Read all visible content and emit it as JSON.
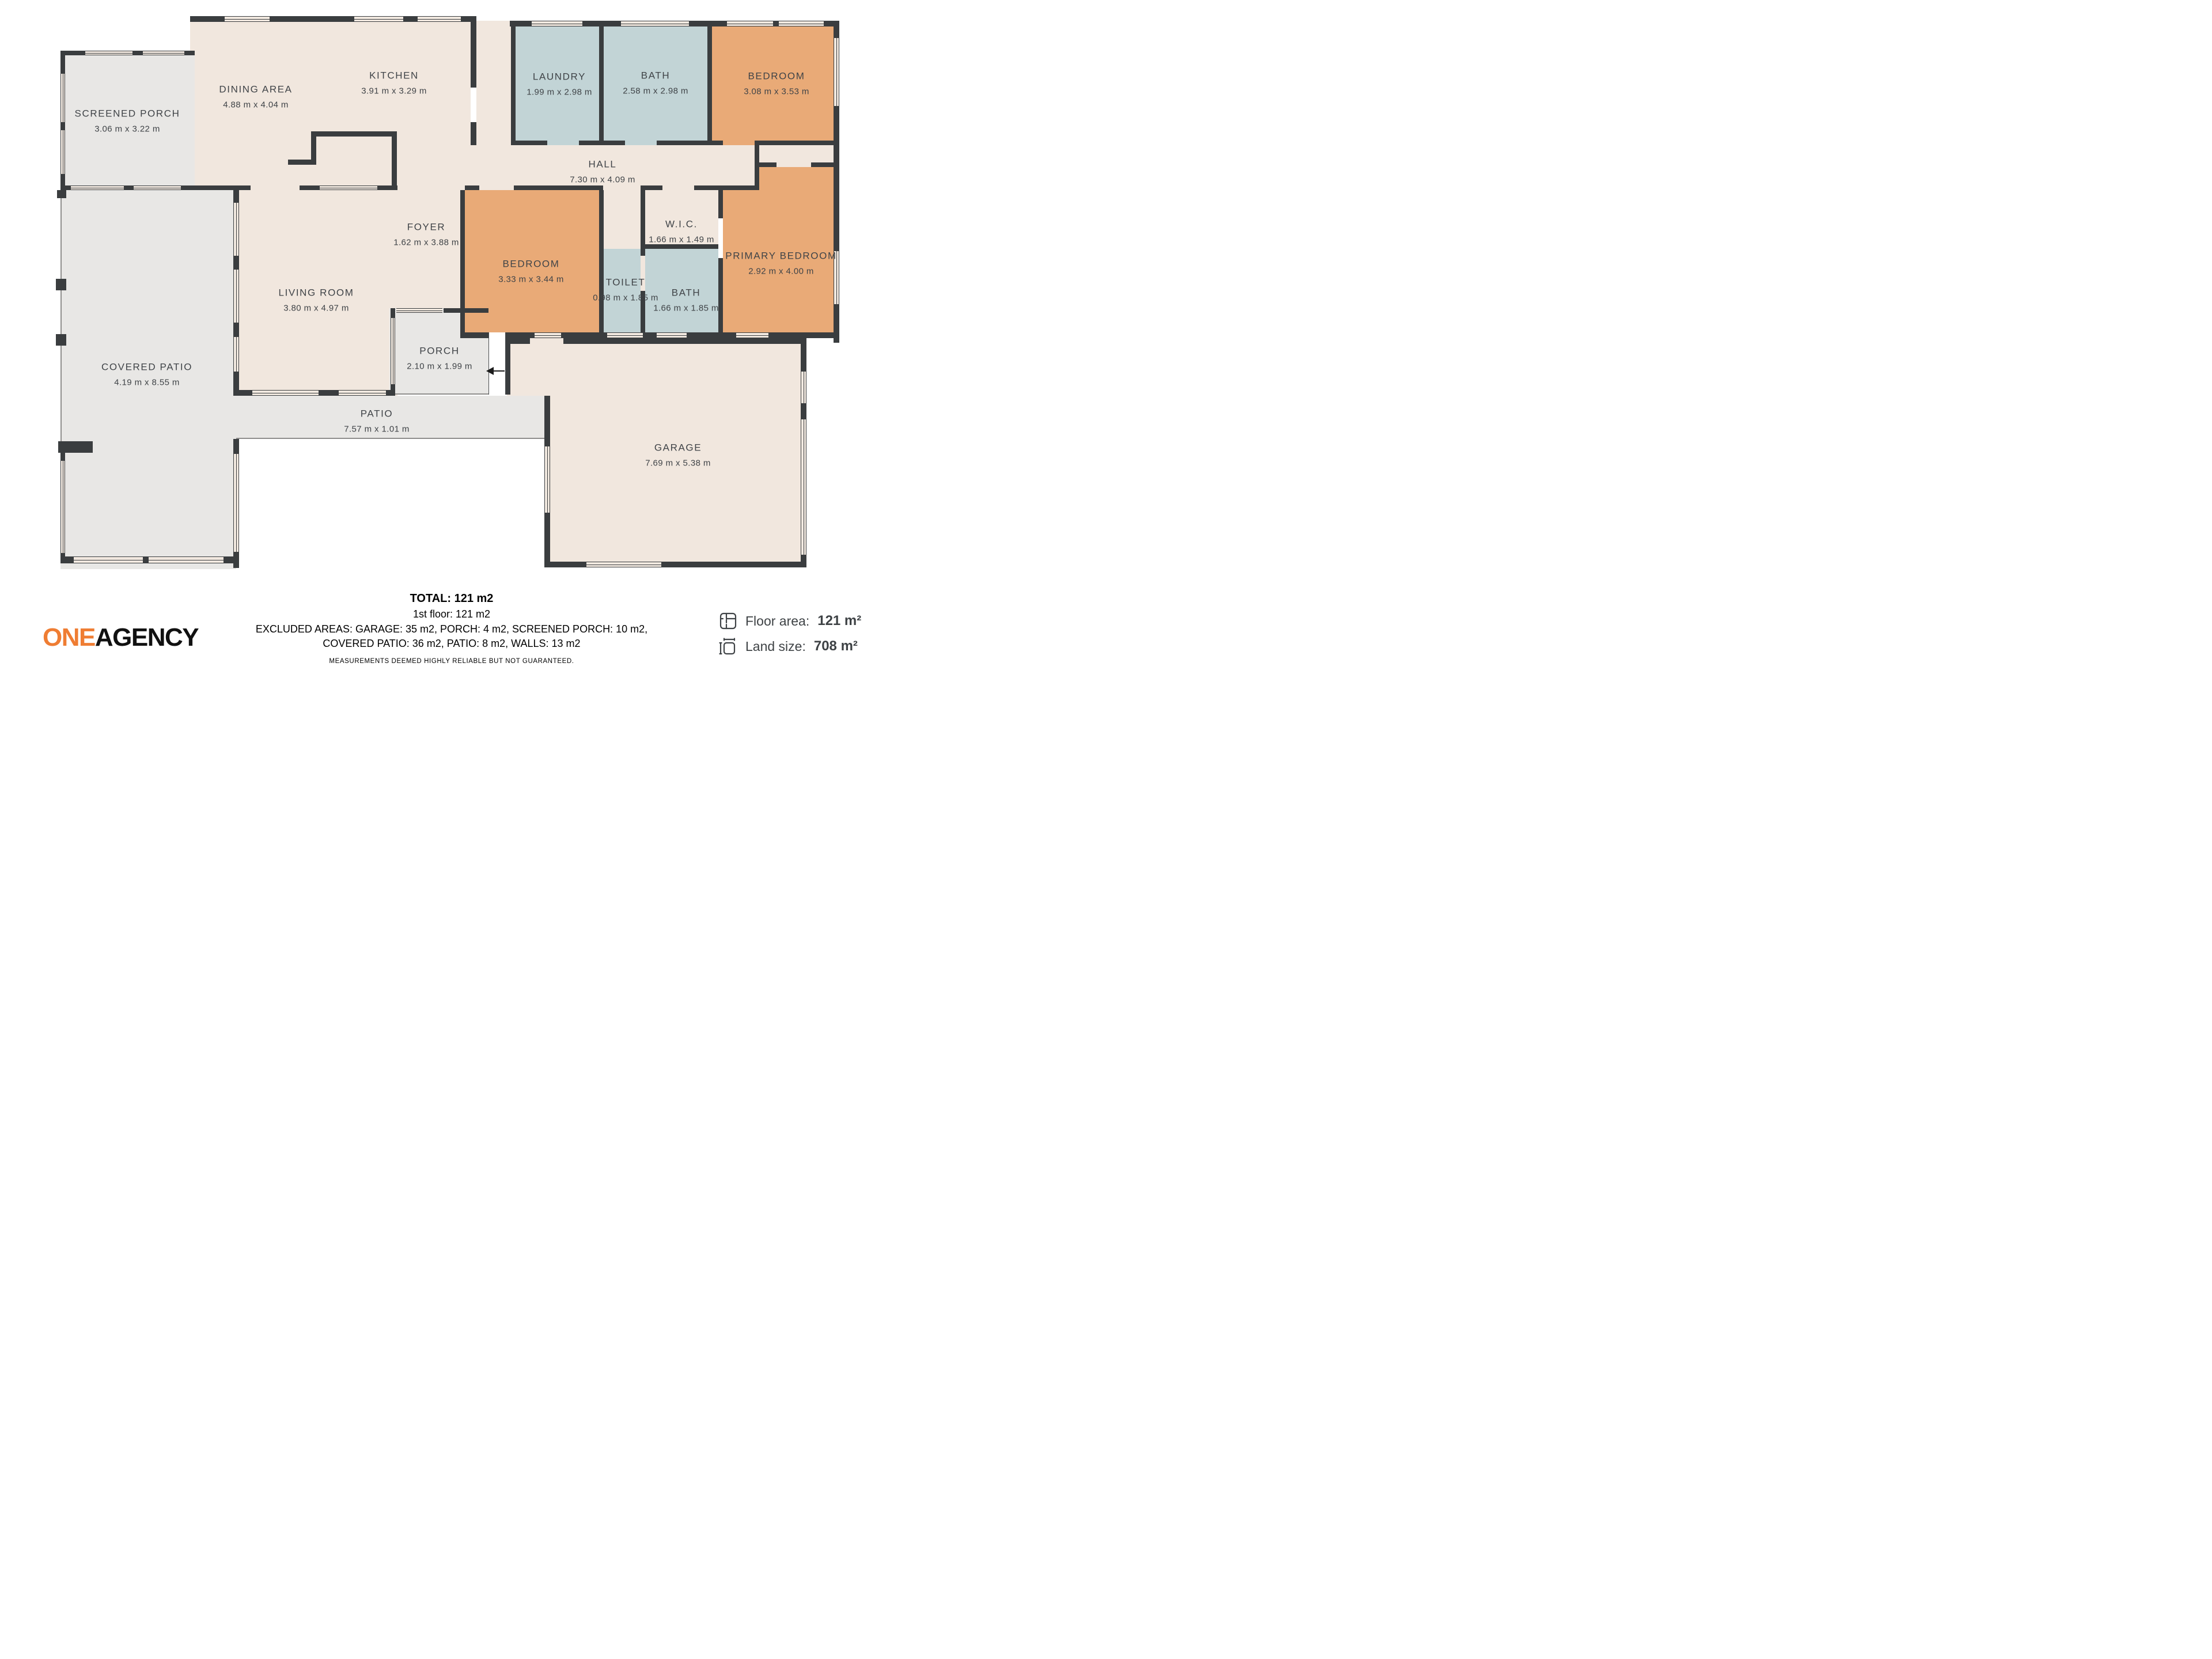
{
  "rooms": {
    "screened_porch": {
      "name": "SCREENED PORCH",
      "dims": "3.06 m x 3.22 m"
    },
    "dining": {
      "name": "DINING AREA",
      "dims": "4.88 m x 4.04 m"
    },
    "kitchen": {
      "name": "KITCHEN",
      "dims": "3.91 m x 3.29 m"
    },
    "laundry": {
      "name": "LAUNDRY",
      "dims": "1.99 m x 2.98 m"
    },
    "bath_top": {
      "name": "BATH",
      "dims": "2.58 m x 2.98 m"
    },
    "bedroom_top": {
      "name": "BEDROOM",
      "dims": "3.08 m x 3.53 m"
    },
    "hall": {
      "name": "HALL",
      "dims": "7.30 m x 4.09 m"
    },
    "foyer": {
      "name": "FOYER",
      "dims": "1.62 m x 3.88 m"
    },
    "wic": {
      "name": "W.I.C.",
      "dims": "1.66 m x 1.49 m"
    },
    "bedroom_mid": {
      "name": "BEDROOM",
      "dims": "3.33 m x 3.44 m"
    },
    "toilet": {
      "name": "TOILET",
      "dims": "0.98 m x 1.85 m"
    },
    "bath_mid": {
      "name": "BATH",
      "dims": "1.66 m x 1.85 m"
    },
    "primary": {
      "name": "PRIMARY BEDROOM",
      "dims": "2.92 m x 4.00 m"
    },
    "living": {
      "name": "LIVING ROOM",
      "dims": "3.80 m x 4.97 m"
    },
    "covered_patio": {
      "name": "COVERED PATIO",
      "dims": "4.19 m x 8.55 m"
    },
    "porch": {
      "name": "PORCH",
      "dims": "2.10 m x 1.99 m"
    },
    "patio": {
      "name": "PATIO",
      "dims": "7.57 m x 1.01 m"
    },
    "garage": {
      "name": "GARAGE",
      "dims": "7.69 m x 5.38 m"
    }
  },
  "summary": {
    "total": "TOTAL: 121 m2",
    "floor1": "1st floor: 121 m2",
    "excluded1": "EXCLUDED AREAS: GARAGE: 35 m2, PORCH: 4 m2, SCREENED PORCH: 10 m2,",
    "excluded2": "COVERED PATIO: 36 m2, PATIO: 8 m2, WALLS: 13 m2",
    "disclaimer": "MEASUREMENTS DEEMED HIGHLY RELIABLE BUT NOT GUARANTEED."
  },
  "brand": {
    "one": "ONE",
    "agency": "AGENCY"
  },
  "stats": {
    "floor_area_label": "Floor area:",
    "floor_area_value": "121 m²",
    "land_size_label": "Land size:",
    "land_size_value": "708 m²"
  },
  "colors": {
    "wall": "#3a3d3f",
    "room_beige": "#f1e7de",
    "outdoor_gray": "#e8e7e5",
    "wet_area_blue": "#c2d4d6",
    "bedroom_orange": "#e9aa77",
    "brand_orange": "#ef7d33"
  }
}
